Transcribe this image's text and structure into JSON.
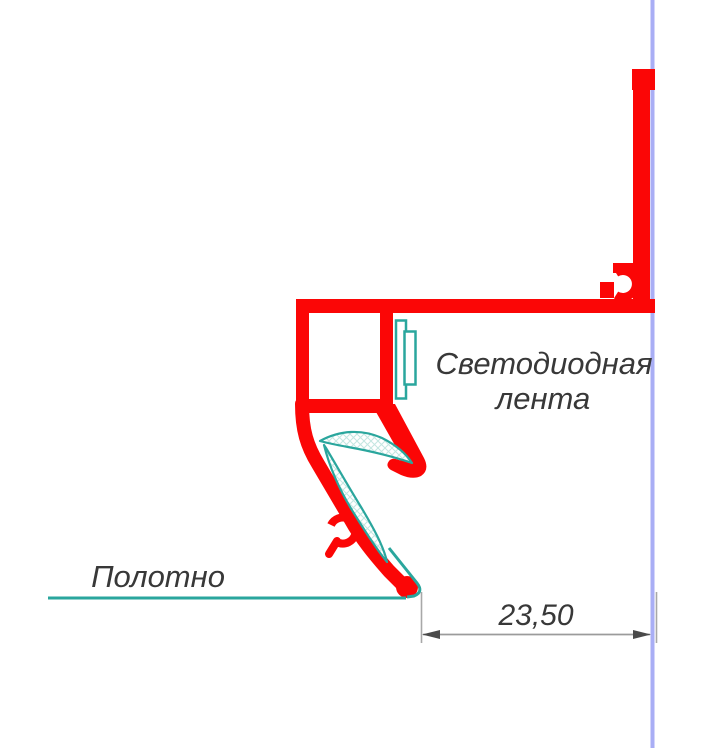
{
  "labels": {
    "led_strip_line1": "Светодиодная",
    "led_strip_line2": "лента",
    "fabric": "Полотно",
    "dimension": "23,50"
  },
  "colors": {
    "profile": "#fb0606",
    "teal": "#2aa69d",
    "wall": "#a9aef5",
    "hatch": "#c3e6e1",
    "text": "#383838",
    "dim_line": "#9b9b9b",
    "ext_line": "#a8a8a8",
    "arrow": "#4a4a4a",
    "white": "#ffffff"
  }
}
